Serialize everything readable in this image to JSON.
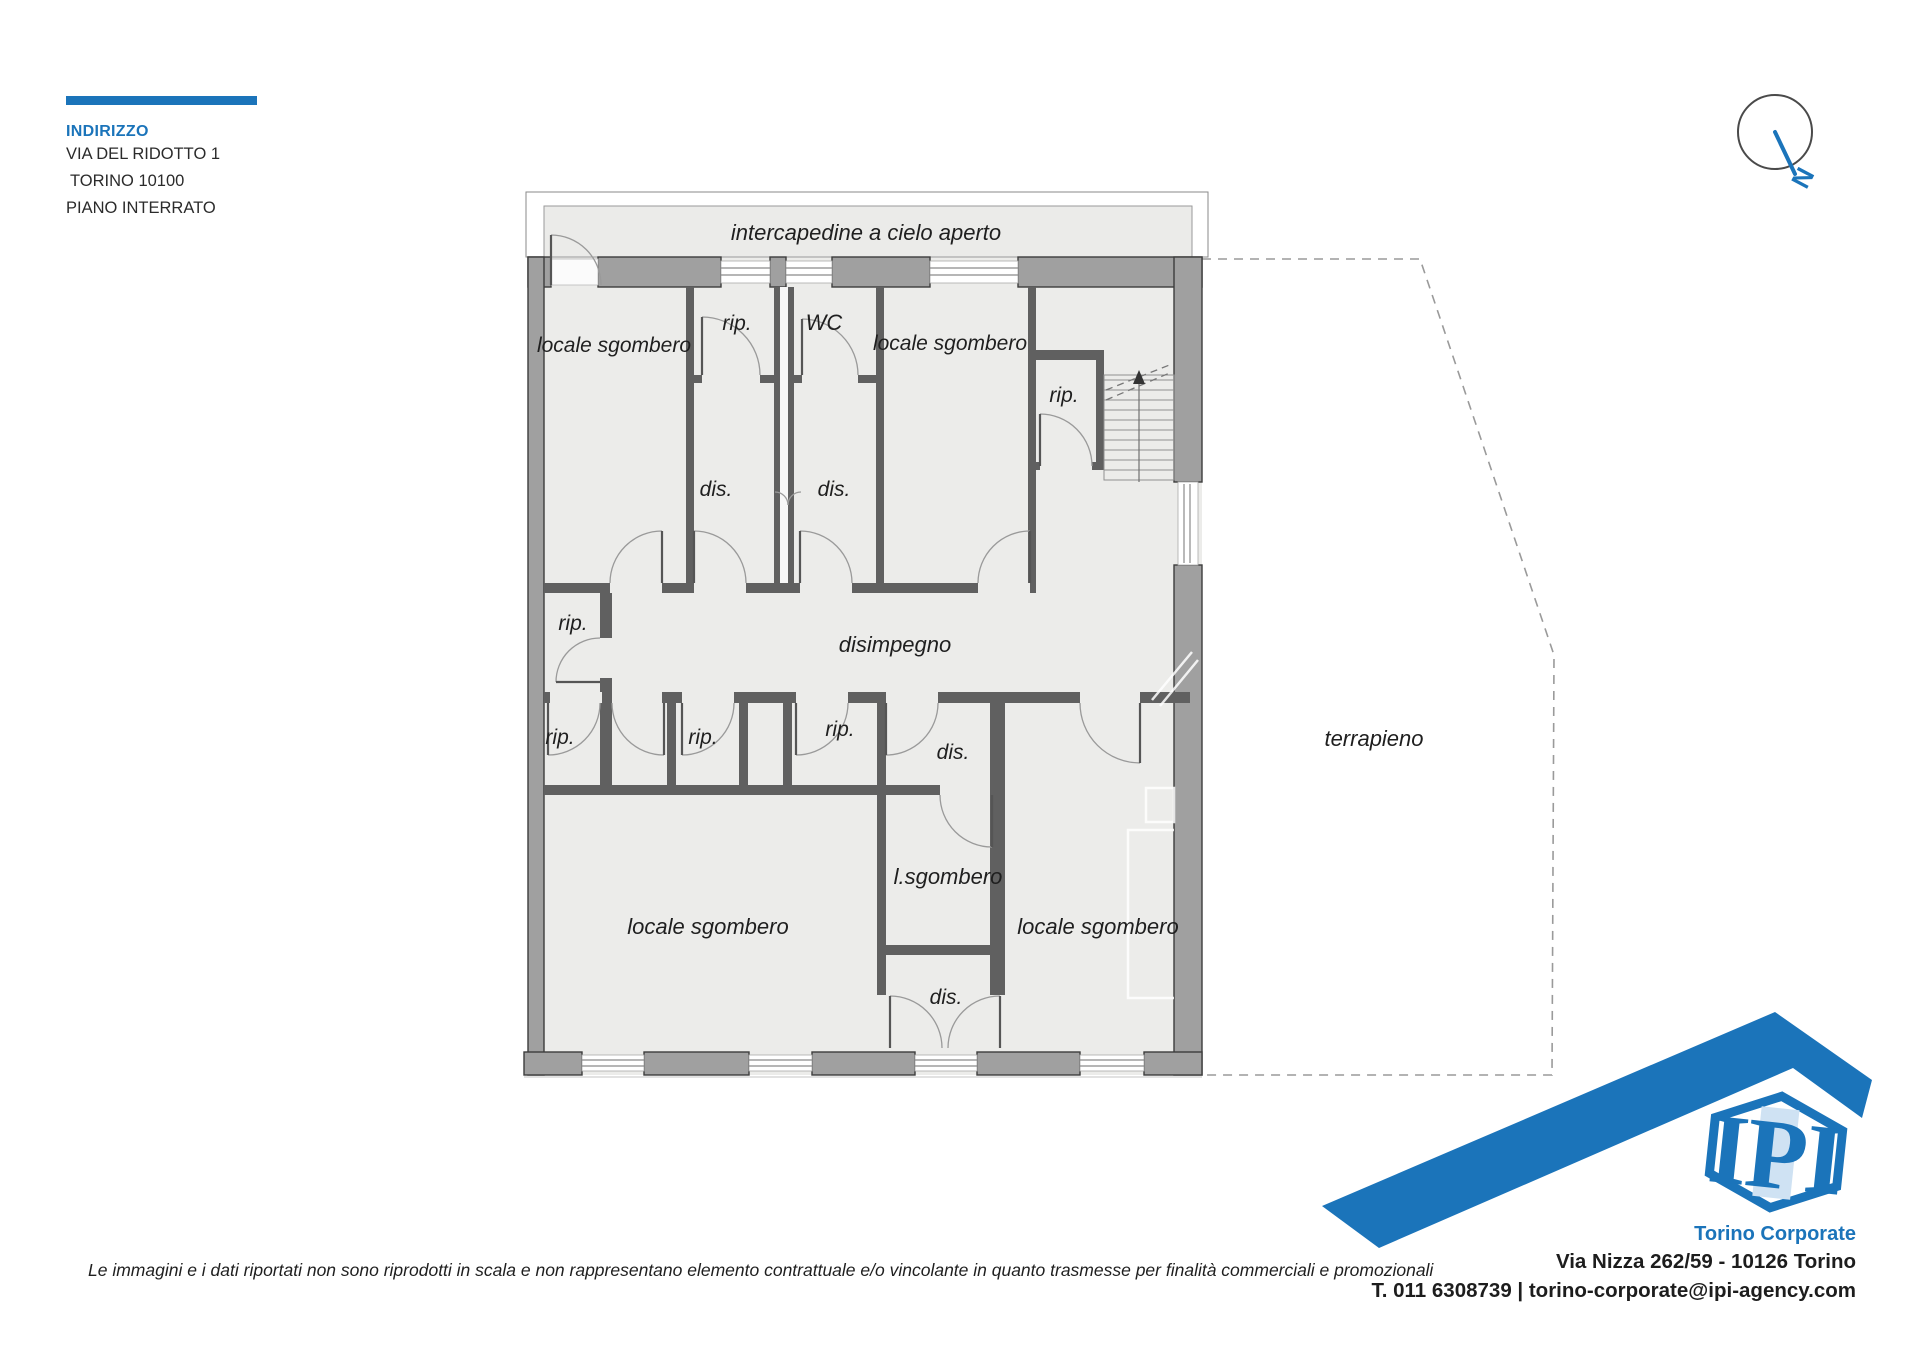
{
  "address_block": {
    "title": "INDIRIZZO",
    "street": "VIA DEL RIDOTTO 1",
    "city": "TORINO 10100",
    "floor": "PIANO INTERRATO"
  },
  "compass": {
    "north_label": "N"
  },
  "plan": {
    "rooms": [
      {
        "name": "intercapedine",
        "label": "intercapedine a cielo aperto"
      },
      {
        "name": "locale-sgombero-nw",
        "label": "locale sgombero"
      },
      {
        "name": "rip-top",
        "label": "rip."
      },
      {
        "name": "wc",
        "label": "WC"
      },
      {
        "name": "locale-sgombero-ne",
        "label": "locale sgombero"
      },
      {
        "name": "rip-stairs",
        "label": "rip."
      },
      {
        "name": "dis-upper-left",
        "label": "dis."
      },
      {
        "name": "dis-upper-right",
        "label": "dis."
      },
      {
        "name": "rip-mid-left",
        "label": "rip."
      },
      {
        "name": "disimpegno",
        "label": "disimpegno"
      },
      {
        "name": "rip-row-left",
        "label": "rip."
      },
      {
        "name": "rip-row-mid",
        "label": "rip."
      },
      {
        "name": "rip-row-right",
        "label": "rip."
      },
      {
        "name": "dis-mid",
        "label": "dis."
      },
      {
        "name": "l-sgombero",
        "label": "l.sgombero"
      },
      {
        "name": "locale-sgombero-sw",
        "label": "locale sgombero"
      },
      {
        "name": "locale-sgombero-se",
        "label": "locale sgombero"
      },
      {
        "name": "dis-bottom",
        "label": "dis."
      },
      {
        "name": "terrapieno",
        "label": "terrapieno"
      }
    ]
  },
  "footer": {
    "disclaimer": "Le immagini e i dati riportati non sono riprodotti in scala e non rappresentano elemento contrattuale e/o vincolante in quanto trasmesse per finalità commerciali e promozionali",
    "brand": {
      "logo_text": "IPI",
      "office": "Torino Corporate",
      "address": "Via Nizza 262/59 - 10126 Torino",
      "contacts": "T. 011 6308739 | torino-corporate@ipi-agency.com"
    }
  },
  "colors": {
    "accent_blue": "#1b74ba"
  }
}
